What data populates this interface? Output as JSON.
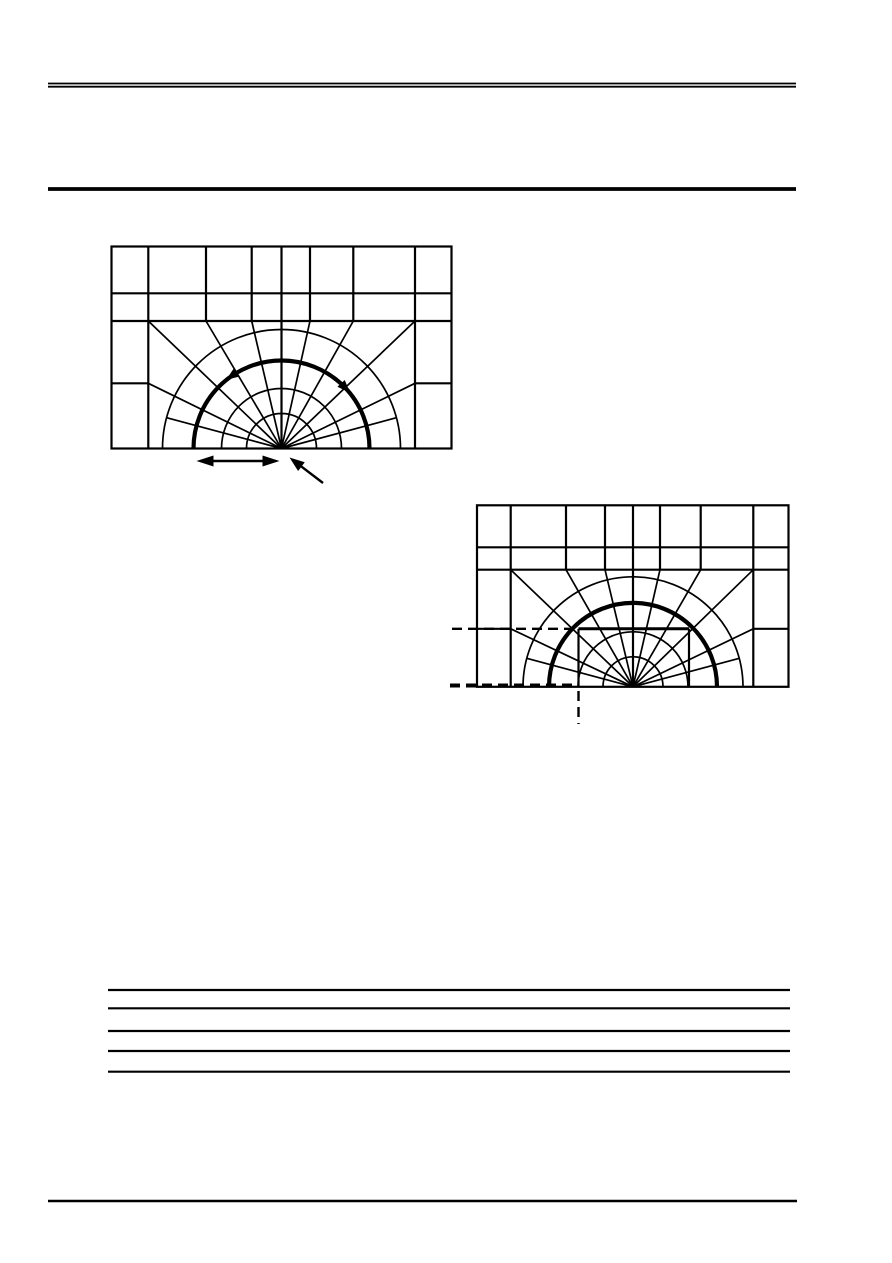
{
  "page": {
    "width": 892,
    "height": 1263,
    "background": "#ffffff",
    "ink": "#000000"
  },
  "header": {
    "double_rule": {
      "x1": 48,
      "x2": 796,
      "y": 83.5,
      "gap": 3.2,
      "weight": 1.8
    },
    "thick_rule": {
      "x1": 48,
      "x2": 796,
      "y": 189,
      "weight": 3.8
    }
  },
  "footer": {
    "rule": {
      "x1": 48,
      "x2": 797,
      "y": 1201,
      "weight": 2.6
    }
  },
  "ruled_lines": {
    "x1": 108,
    "x2": 790,
    "weight": 2.2,
    "ys": [
      990,
      1008.3,
      1031,
      1051,
      1071.7
    ]
  },
  "figures": [
    {
      "name": "figure-notch-mesh-with-arrows",
      "rect": {
        "x": 111.5,
        "y": 246.5,
        "w": 340,
        "h": 202
      },
      "rows": [
        293.3,
        321
      ],
      "stub_y": 383.3,
      "verticals": [
        148.3,
        206,
        251.7,
        281.5,
        310,
        353.3,
        415
      ],
      "center": [
        281.5,
        448.5
      ],
      "radii": [
        35,
        60,
        88,
        119
      ],
      "thick_index": 2,
      "arc_ray_angles": [
        15,
        165
      ],
      "stroke": {
        "thin": 1.7,
        "grid": 2.2,
        "thick": 4.2
      },
      "arc_arrowheads": [
        {
          "angle_deg": 125,
          "direction": "ccw"
        },
        {
          "angle_deg": 43,
          "direction": "cw"
        }
      ],
      "dimension_arrow": {
        "x1": 196.5,
        "x2": 279.5,
        "y": 461
      },
      "pointer_arrow": {
        "tail": [
          323,
          483
        ],
        "tip": [
          289.5,
          457.5
        ]
      }
    },
    {
      "name": "figure-notch-mesh-with-zoom-region",
      "rect": {
        "x": 477,
        "y": 505.3,
        "w": 311.5,
        "h": 181.5
      },
      "rows": [
        547.3,
        569.7
      ],
      "stub_y": 628.8,
      "verticals": [
        510.7,
        566,
        605,
        633,
        660,
        700.7,
        753.3
      ],
      "center": [
        633,
        686.8
      ],
      "radii": [
        30,
        55,
        84,
        110
      ],
      "thick_index": 2,
      "arc_ray_angles": [
        15,
        165
      ],
      "stroke": {
        "thin": 1.7,
        "grid": 2.2,
        "thick": 4.2
      },
      "region_box": {
        "x1": 578.5,
        "x2": 689,
        "top": 628.8,
        "weight": 2.2,
        "top_weight": 3
      },
      "dashed_lines": {
        "dash": "10 6",
        "h": [
          {
            "y": 628.8,
            "x1": 452,
            "x2": 578.5,
            "w": 2.4
          },
          {
            "y": 685.5,
            "x1": 450,
            "x2": 578.5,
            "w": 4
          }
        ],
        "v": {
          "x": 578.5,
          "y1": 691,
          "y2": 724,
          "w": 2.4
        }
      }
    }
  ]
}
